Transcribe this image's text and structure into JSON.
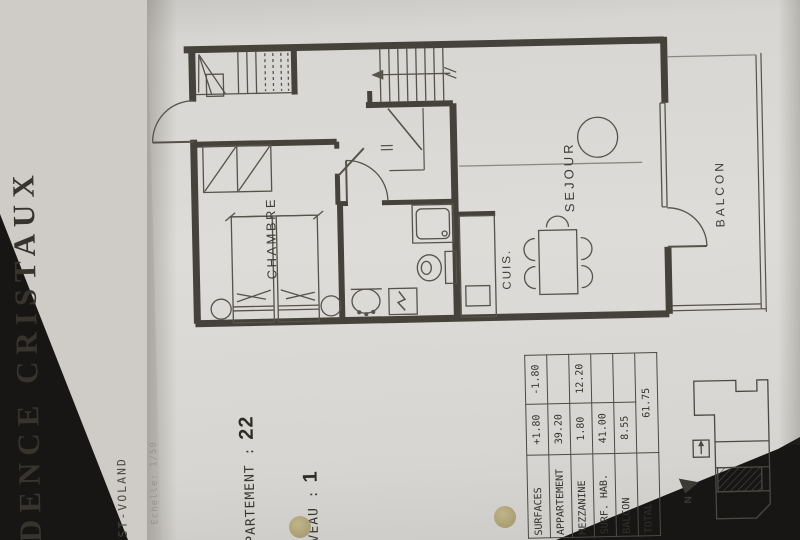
{
  "cover": {
    "title": "IDENCE CRISTAUX",
    "location": "REST-VOLAND",
    "scale_note": "Echelle: 1/50"
  },
  "header": {
    "apartment_label": "PPARTEMENT :",
    "apartment_value": "22",
    "level_label": "IVEAU :",
    "level_value": "1"
  },
  "floor_plan": {
    "rooms": [
      {
        "id": "chambre",
        "label": "CHAMBRE"
      },
      {
        "id": "cuisine",
        "label": "CUIS."
      },
      {
        "id": "sejour",
        "label": "SEJOUR"
      },
      {
        "id": "balcon",
        "label": "BALCON"
      }
    ]
  },
  "surfaces_table": {
    "rows": [
      {
        "label": "SURFACES",
        "plus": "+1.80",
        "minus": "-1.80"
      },
      {
        "label": "APPARTEMENT",
        "plus": "39.20",
        "minus": ""
      },
      {
        "label": "MEZZANINE",
        "plus": "1.80",
        "minus": "12.20"
      },
      {
        "label": "SURF. HAB.",
        "plus": "41.00",
        "minus": ""
      },
      {
        "label": "BALCON",
        "plus": "8.55",
        "minus": ""
      },
      {
        "label": "TOTAL",
        "total": "61.75"
      }
    ]
  },
  "site_plan": {
    "north_label": "N"
  },
  "colors": {
    "background": "#171615",
    "paper": "#dedcd8",
    "cover_paper": "#cfccc7",
    "ink": "#3d3b36",
    "wall": "#45423b",
    "hole_punch": "#a89c72"
  }
}
